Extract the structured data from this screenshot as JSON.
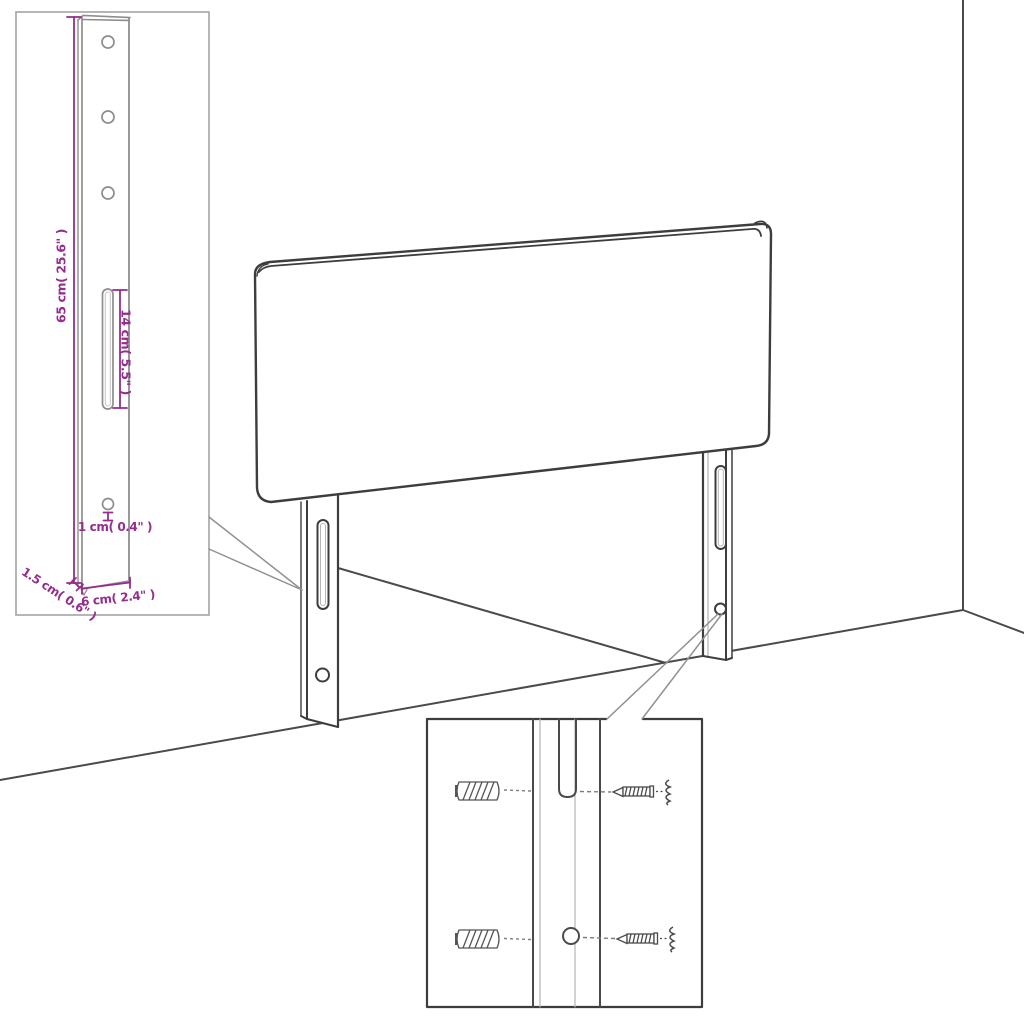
{
  "diagram": {
    "type": "headboard-assembly-dimension-diagram",
    "inset_top_left": {
      "height_label": "65 cm( 25.6\" )",
      "slot_length_label": "14 cm( 5.5\" )",
      "hole_diameter_label": "1 cm( 0.4\" )",
      "width_label": "6 cm( 2.4\" )",
      "thickness_label": "1.5 cm( 0.6\" )"
    },
    "colors": {
      "dimension_accent": "#942d8c",
      "line_art": "#3d3d3d",
      "inset_line_art": "#8e8e8e",
      "callout_line": "#919191",
      "background": "#ffffff"
    }
  }
}
